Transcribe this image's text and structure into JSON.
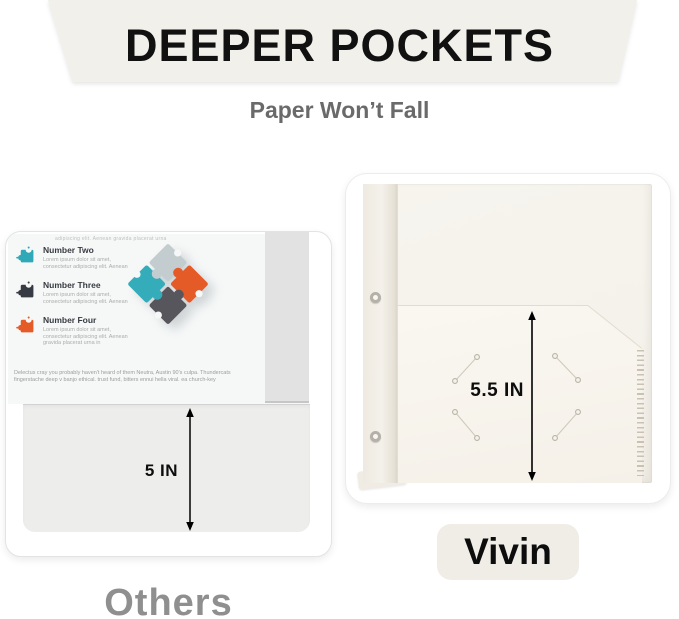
{
  "header": {
    "title": "DEEPER POCKETS",
    "subtitle": "Paper Won’t Fall"
  },
  "left_panel": {
    "brand_label": "Others",
    "pocket_depth": "5 IN",
    "document": {
      "clipped_top_text": "adipiscing elit. Aenean gravida placerat urna in",
      "items": [
        {
          "label": "Number Two",
          "color": "#2fa9b7",
          "description": "Lorem ipsum dolor sit amet, consectetur adipiscing elit. Aenean"
        },
        {
          "label": "Number Three",
          "color": "#363a43",
          "description": "Lorem ipsum dolor sit amet, consectetur adipiscing elit. Aenean"
        },
        {
          "label": "Number Four",
          "color": "#e55b27",
          "description": "Lorem ipsum dolor sit amet, consectetur adipiscing elit. Aenean gravida placerat urna in"
        }
      ],
      "paragraph": "Delectus cray you probably haven't heard of them Neutra, Austin 90's culpa. Thundercats fingerstache deep v banjo ethical. trust fund, bitters ennui hella viral. ea church-key"
    }
  },
  "right_panel": {
    "brand_label": "Vivin",
    "pocket_depth": "5.5 IN"
  },
  "colors": {
    "banner_bg": "#f2f0ea",
    "title_text": "#111111",
    "subtitle_text": "#6a6a6a",
    "others_text": "#8f8f8f",
    "badge_bg": "#f0ede6",
    "folder_cream": "#f5f2ec",
    "puzzle_gray": "#c3cdd0",
    "puzzle_teal": "#35acba",
    "puzzle_orange": "#e55b27",
    "puzzle_dark": "#56565c",
    "notch_white": "#f6f8f8"
  }
}
